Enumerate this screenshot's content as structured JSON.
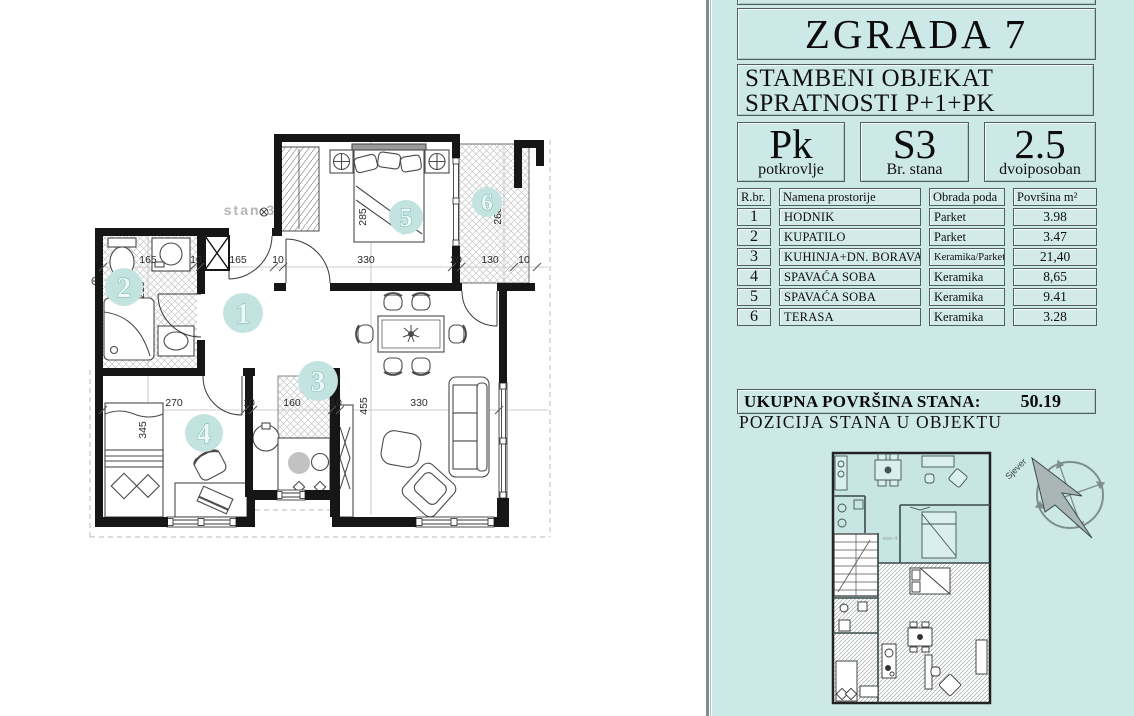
{
  "panel": {
    "title": "ZGRADA 7",
    "subtitle_line1": "STAMBENI OBJEKAT",
    "subtitle_line2": "SPRATNOSTI P+1+PK",
    "info_boxes": [
      {
        "big": "Pk",
        "small": "potkrovlje"
      },
      {
        "big": "S3",
        "small": "Br. stana"
      },
      {
        "big": "2.5",
        "small": "dvoiposoban"
      }
    ],
    "table": {
      "headers": [
        "R.br.",
        "Namena prostorije",
        "Obrada poda",
        "Površina  m²"
      ],
      "rows": [
        {
          "num": "1",
          "name": "HODNIK",
          "floor": "Parket",
          "area": "3.98"
        },
        {
          "num": "2",
          "name": "KUPATILO",
          "floor": "Parket",
          "area": "3.47"
        },
        {
          "num": "3",
          "name": "KUHINJA+DN. BORAVAK",
          "floor": "Keramika/Parket",
          "area": "21,40"
        },
        {
          "num": "4",
          "name": "SPAVAĆA SOBA",
          "floor": "Keramika",
          "area": "8,65"
        },
        {
          "num": "5",
          "name": "SPAVAĆA SOBA",
          "floor": "Keramika",
          "area": "9.41"
        },
        {
          "num": "6",
          "name": "TERASA",
          "floor": "Keramika",
          "area": "3.28"
        }
      ]
    },
    "total_label": "UKUPNA POVRŠINA STANA:",
    "total_value": "50.19",
    "position_label": "POZICIJA STANA  U OBJEKTU",
    "mini_unit_label": "stan 4",
    "compass_label": "Sjever"
  },
  "plan": {
    "unit_label": "stan 3",
    "rooms": [
      "1",
      "2",
      "3",
      "4",
      "5",
      "6"
    ],
    "dims_top": [
      "165",
      "10",
      "165",
      "10",
      "330",
      "20",
      "130",
      "10"
    ],
    "dims_mid": [
      "270",
      "10",
      "160",
      "10",
      "330"
    ],
    "dims_vert": {
      "bathroom": "210",
      "bedroom4": "345",
      "bedroom5": "285",
      "terrace": "260",
      "living": "455"
    }
  },
  "colors": {
    "panel_bg": "#cde9e7",
    "cell_bg": "#d2ebe9",
    "room_badge_fill": "#c3e3e0",
    "room_badge_stroke": "#6fb5b1",
    "wall": "#161616",
    "hatch": "#c6c6c6"
  }
}
